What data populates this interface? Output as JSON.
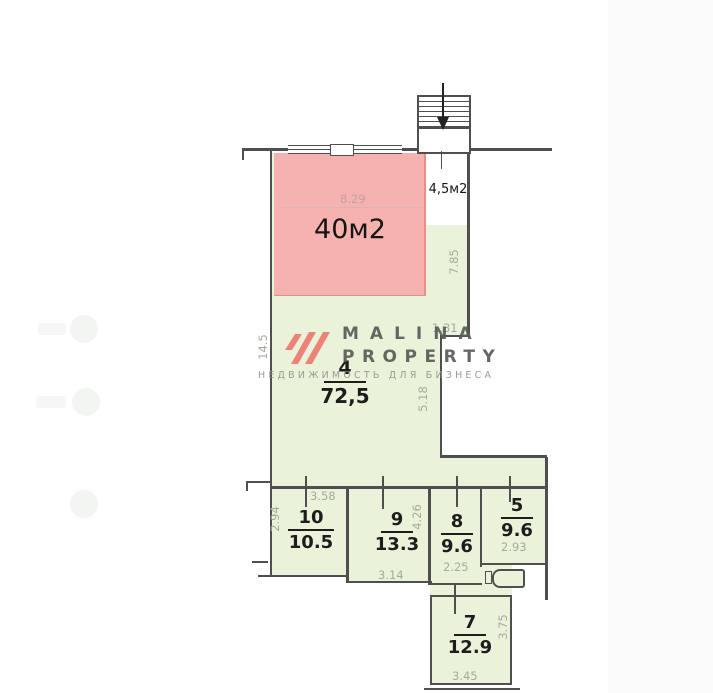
{
  "plan": {
    "type": "floor-plan",
    "highlight": {
      "area_label": "40м2",
      "annex_label": "4,5м2"
    },
    "main_room": {
      "number": "4",
      "area": "72,5"
    },
    "rooms": [
      {
        "number": "10",
        "area": "10.5"
      },
      {
        "number": "9",
        "area": "13.3"
      },
      {
        "number": "8",
        "area": "9.6"
      },
      {
        "number": "5",
        "area": "9.6"
      },
      {
        "number": "7",
        "area": "12.9"
      }
    ],
    "dimensions": [
      {
        "value": "8.29",
        "orientation": "h"
      },
      {
        "value": "7.85",
        "orientation": "v"
      },
      {
        "value": "1.31",
        "orientation": "h"
      },
      {
        "value": "5.18",
        "orientation": "v"
      },
      {
        "value": "14.5",
        "orientation": "v"
      },
      {
        "value": "2.94",
        "orientation": "v"
      },
      {
        "value": "3.58",
        "orientation": "h"
      },
      {
        "value": "4.26",
        "orientation": "v"
      },
      {
        "value": "3.14",
        "orientation": "h"
      },
      {
        "value": "2.25",
        "orientation": "h"
      },
      {
        "value": "2.93",
        "orientation": "h"
      },
      {
        "value": "3.75",
        "orientation": "v"
      },
      {
        "value": "3.45",
        "orientation": "h"
      }
    ]
  },
  "logo": {
    "line1": "MALINA",
    "line2": "PROPERTY",
    "tagline": "НЕДВИЖИМОСТЬ ДЛЯ БИЗНЕСА"
  },
  "icons": {
    "stairs_arrow": "down-arrow"
  },
  "colors": {
    "highlight_fill": "#f6b2af",
    "highlight_edge": "#eb8e8b",
    "room_fill": "#eaf3da",
    "wall": "#4f4f4f",
    "dimension_text": "#a5ab9b",
    "logo_red": "#ee7b70",
    "logo_text": "#585d58"
  }
}
